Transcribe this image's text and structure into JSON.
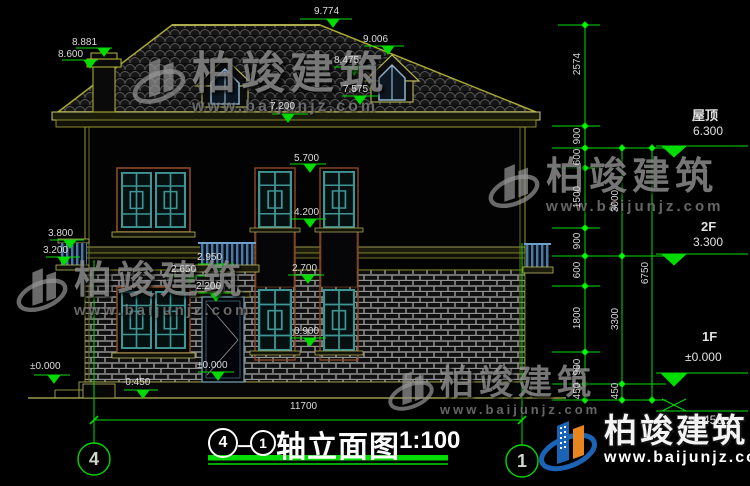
{
  "watermark": {
    "brand": "柏竣建筑",
    "url": "www.baijunjz.com"
  },
  "title": {
    "c4": "4",
    "dash": "－",
    "c1": "1",
    "name": "轴立面图",
    "scale": "1:100"
  },
  "ann": {
    "v9774": "9.774",
    "v8881": "8.881",
    "v8600": "8.600",
    "v9006": "9.006",
    "v8475": "8.475",
    "v7575": "7.575",
    "v7200": "7.200",
    "v5700": "5.700",
    "v4200": "4.200",
    "v2700": "2.700",
    "v0900": "0.900",
    "v3800": "3.800",
    "v3200": "3.200",
    "v2950": "2.950",
    "v2650": "2.650",
    "v2200": "2.200",
    "vzero": "±0.000",
    "vneg": "-0.450",
    "d11700": "11700"
  },
  "dims": {
    "d2574": "2574",
    "d900": "900",
    "d600": "600",
    "d1500": "1500",
    "d1800": "1800",
    "d450": "450",
    "d3000": "3000",
    "d3300": "3300",
    "d6750": "6750"
  },
  "levels": {
    "roof_name": "屋顶",
    "roof_val": "6.300",
    "f2_name": "2F",
    "f2_val": "3.300",
    "f1_name": "1F",
    "f1_val": "±0.000",
    "base_val": "-0.450"
  }
}
